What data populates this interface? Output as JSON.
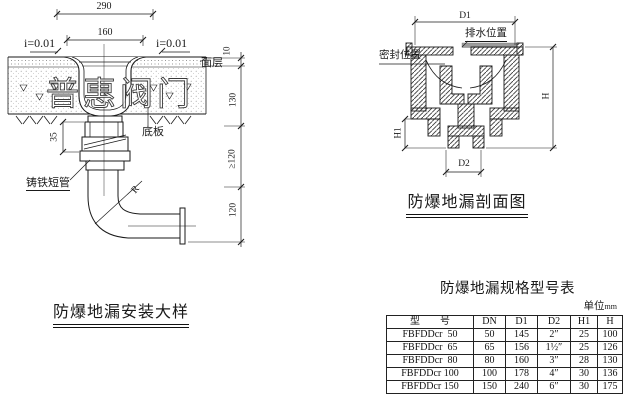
{
  "page": {
    "paper": "#ffffff",
    "line_color": "#1a1a1a",
    "seal_strip_gray": "#9c9c9c"
  },
  "installation_detail": {
    "title": "防爆地漏安装大样",
    "watermark": "普惠阀门",
    "dims": {
      "top_width": "290",
      "inner_width": "160",
      "slope_left": "i=0.01",
      "slope_right": "i=0.01",
      "surface_thk": "10",
      "slab_thk": "130",
      "min_embed": "≥120",
      "outlet_drop": "120",
      "flange_height": "35",
      "radius": "R"
    },
    "labels": {
      "surface": "面层",
      "base_plate": "底板",
      "cast_iron_pipe": "铸铁短管"
    }
  },
  "section_view": {
    "title": "防爆地漏剖面图",
    "dims": {
      "d1": "D1",
      "d2": "D2",
      "h": "H",
      "h1": "H1"
    },
    "labels": {
      "drain_position": "排水位置",
      "seal_position": "密封位置"
    }
  },
  "spec_table": {
    "title": "防爆地漏规格型号表",
    "unit_prefix": "单位",
    "unit_suffix": "mm",
    "headers": [
      "型        号",
      "DN",
      "D1",
      "D2",
      "H1",
      "H"
    ],
    "rows": [
      [
        "FBFDDcr  50",
        "50",
        "145",
        "2″",
        "25",
        "100"
      ],
      [
        "FBFDDcr  65",
        "65",
        "156",
        "1½″",
        "25",
        "126"
      ],
      [
        "FBFDDcr  80",
        "80",
        "160",
        "3″",
        "28",
        "130"
      ],
      [
        "FBFDDcr 100",
        "100",
        "178",
        "4″",
        "30",
        "136"
      ],
      [
        "FBFDDcr 150",
        "150",
        "240",
        "6″",
        "30",
        "175"
      ]
    ]
  }
}
